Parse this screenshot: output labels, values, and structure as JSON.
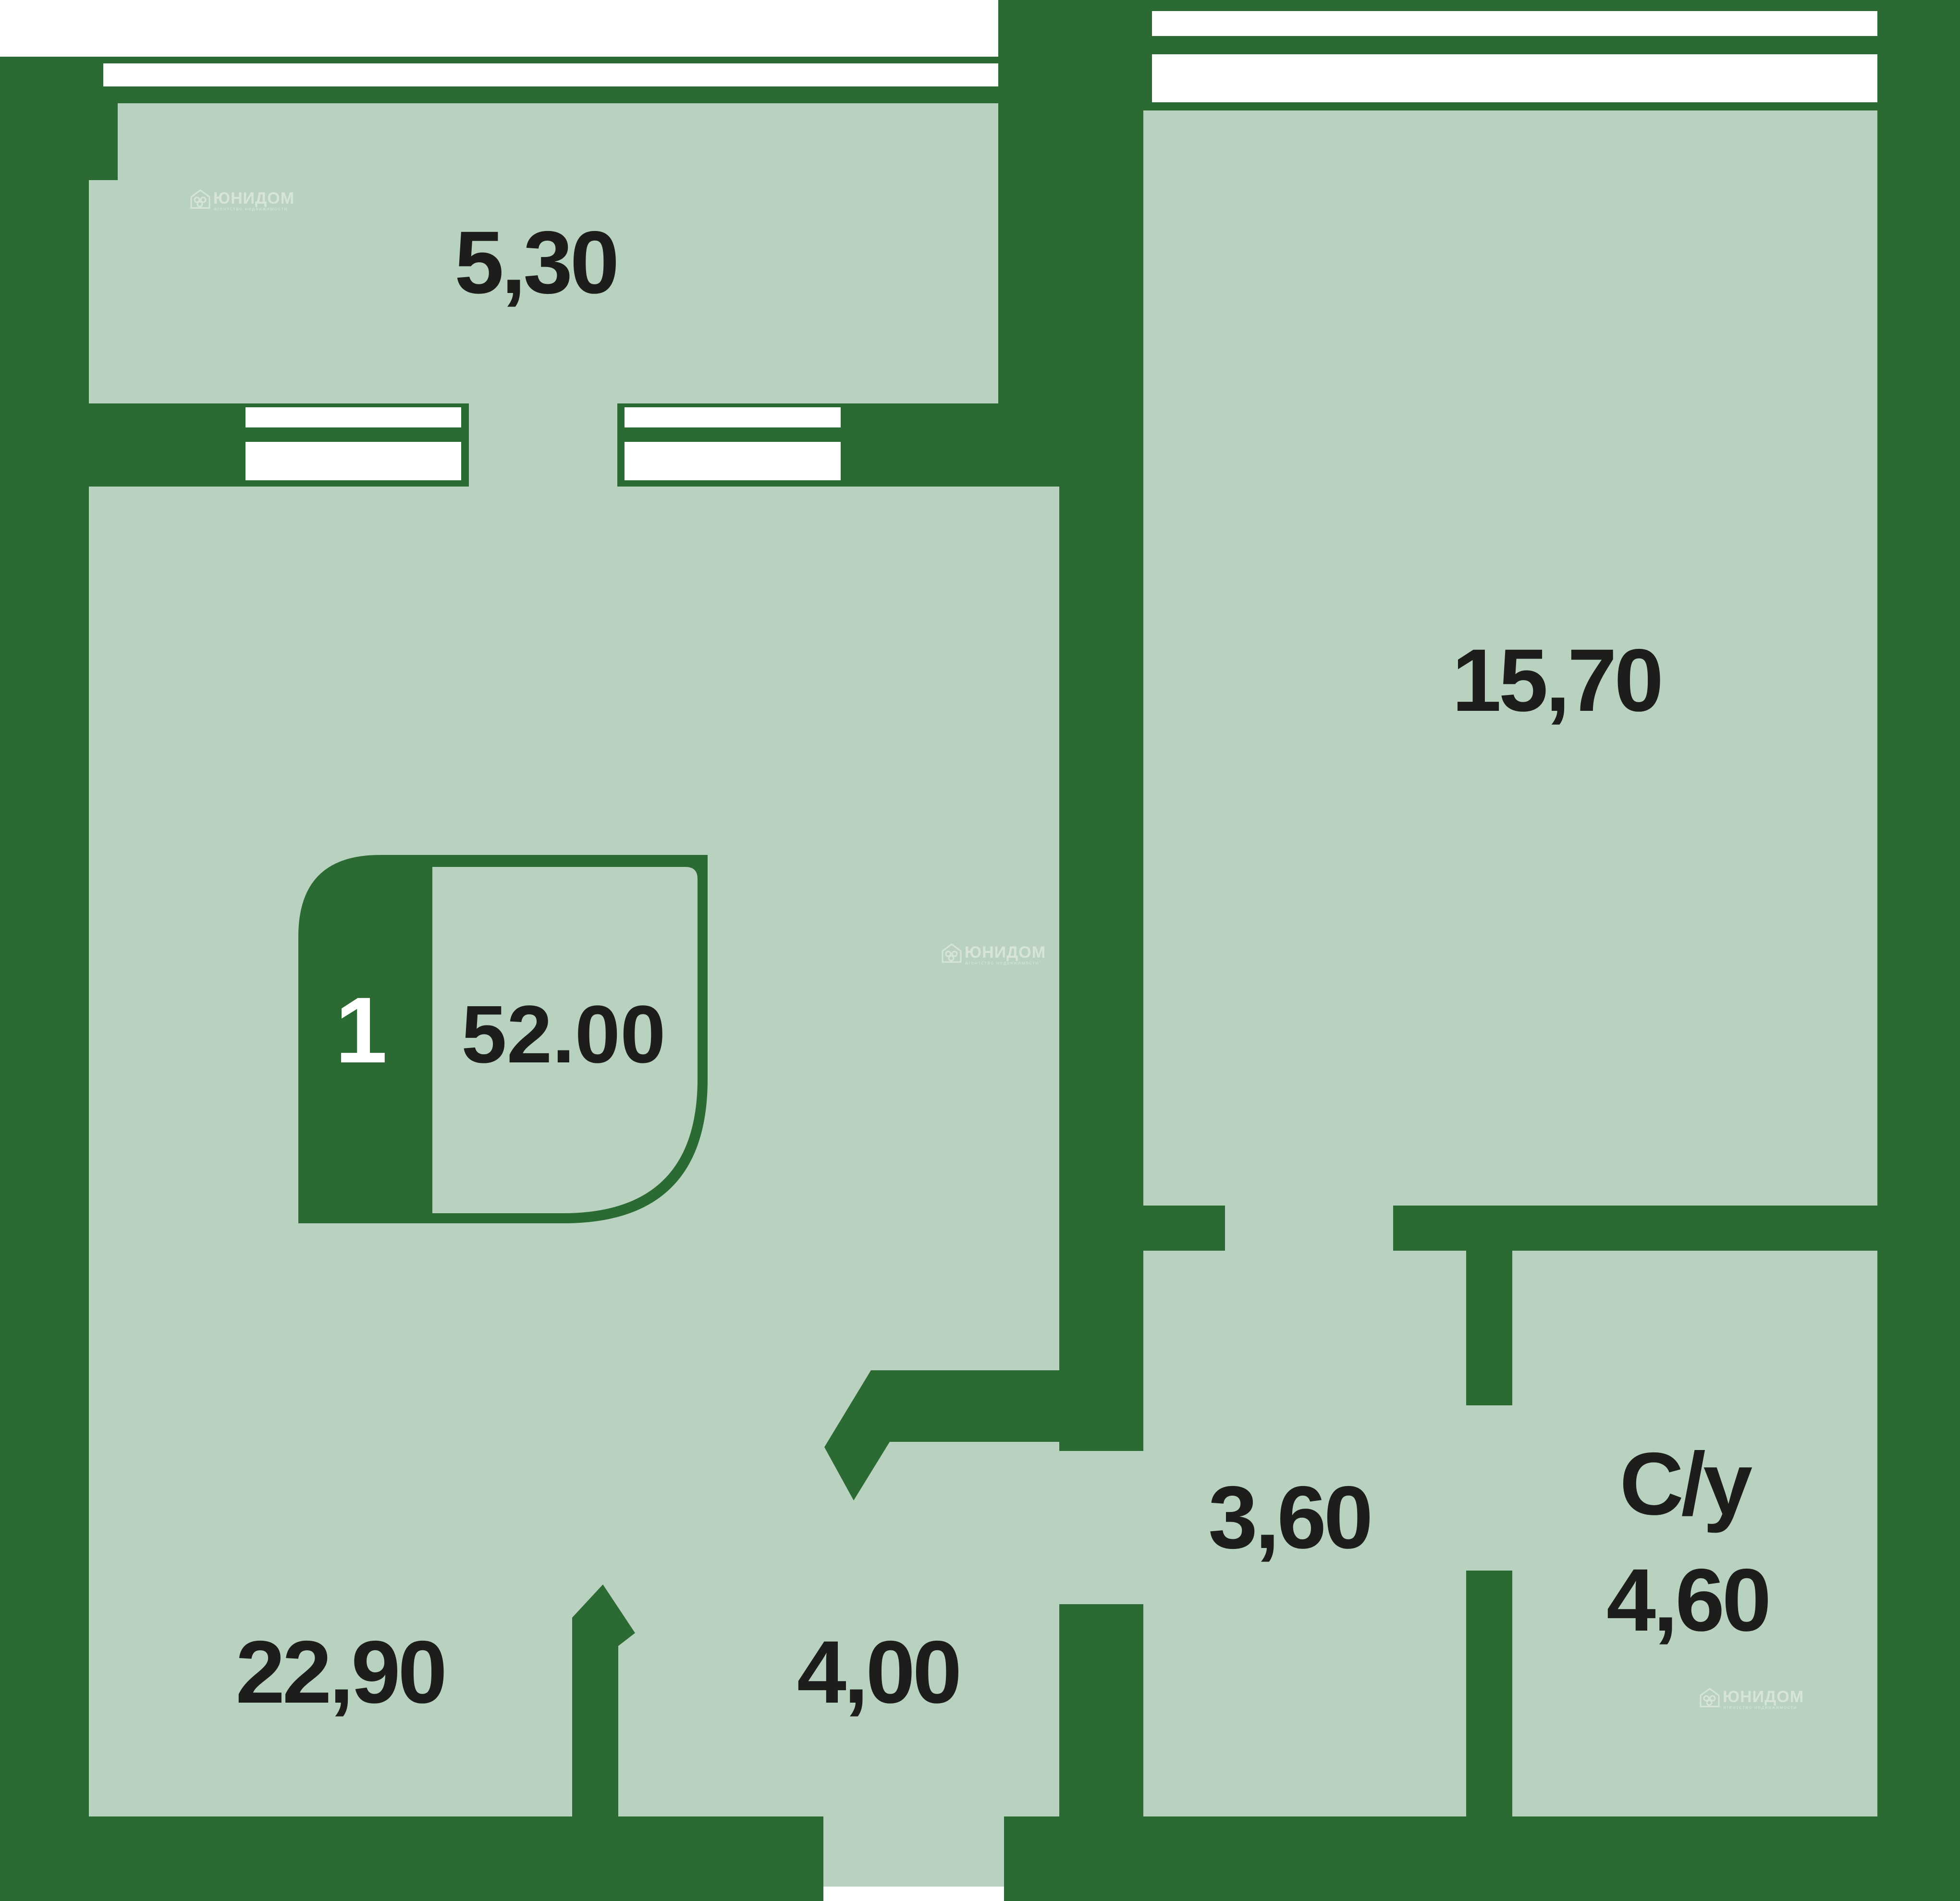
{
  "floor_plan": {
    "badge": {
      "room_count": "1",
      "total_area": "52.00"
    },
    "rooms": {
      "balcony": {
        "label": "5,30"
      },
      "bedroom": {
        "label": "15,70"
      },
      "living_room": {
        "label": "22,90"
      },
      "hallway": {
        "label": "4,00"
      },
      "corridor": {
        "label": "3,60"
      },
      "bathroom_name": {
        "label": "С/у"
      },
      "bathroom_area": {
        "label": "4,60"
      }
    },
    "watermark": {
      "brand": "ЮНИДОМ",
      "tagline": "агентство недвижимости"
    },
    "colors": {
      "wall": "#2c6a34",
      "floor": "#b9d2bf",
      "window": "#ffffff",
      "label": "#1d1d1b",
      "badge_text": "#ffffff"
    }
  }
}
